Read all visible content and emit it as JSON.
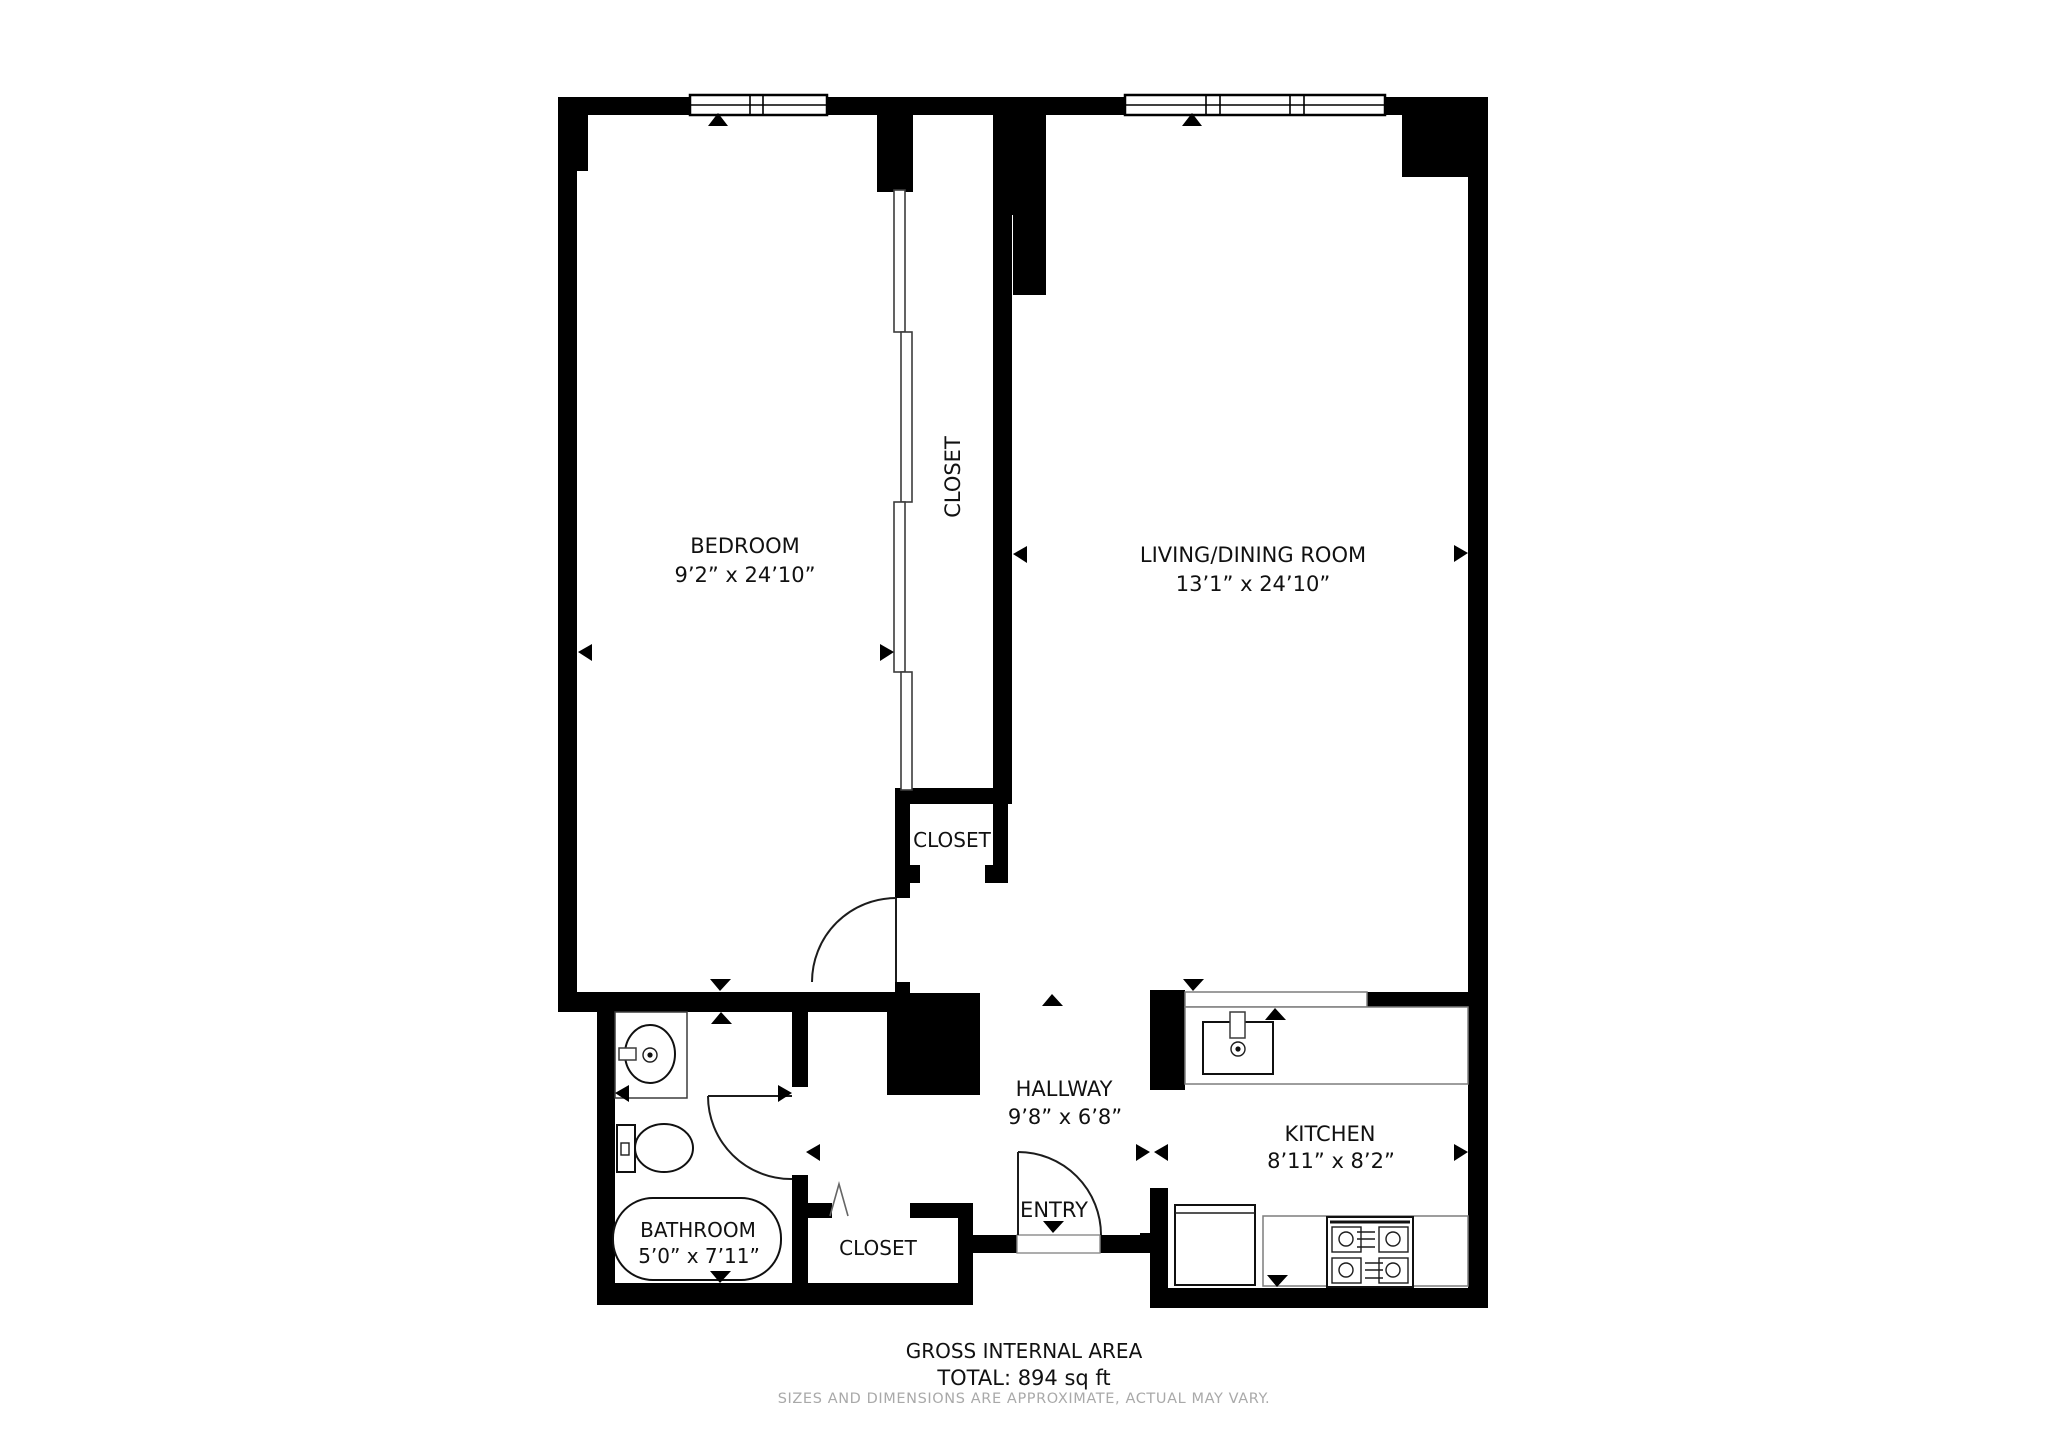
{
  "colors": {
    "wall": "#000000",
    "text": "#111111",
    "muted": "#a9a9a9"
  },
  "rooms": {
    "bedroom": {
      "label": "BEDROOM",
      "dims": "9’2” x 24’10”"
    },
    "living": {
      "label": "LIVING/DINING ROOM",
      "dims": "13’1” x 24’10”"
    },
    "closet_tall": {
      "label": "CLOSET"
    },
    "closet_mid": {
      "label": "CLOSET"
    },
    "closet_entry": {
      "label": "CLOSET"
    },
    "hallway": {
      "label": "HALLWAY",
      "dims": "9’8” x 6’8”"
    },
    "entry": {
      "label": "ENTRY"
    },
    "kitchen": {
      "label": "KITCHEN",
      "dims": "8’11” x 8’2”"
    },
    "bathroom": {
      "label": "BATHROOM",
      "dims": "5’0” x 7’11”"
    }
  },
  "footer": {
    "area_title": "GROSS INTERNAL AREA",
    "area_total": "TOTAL: 894 sq ft",
    "disclaimer": "SIZES AND DIMENSIONS ARE APPROXIMATE, ACTUAL MAY VARY."
  }
}
